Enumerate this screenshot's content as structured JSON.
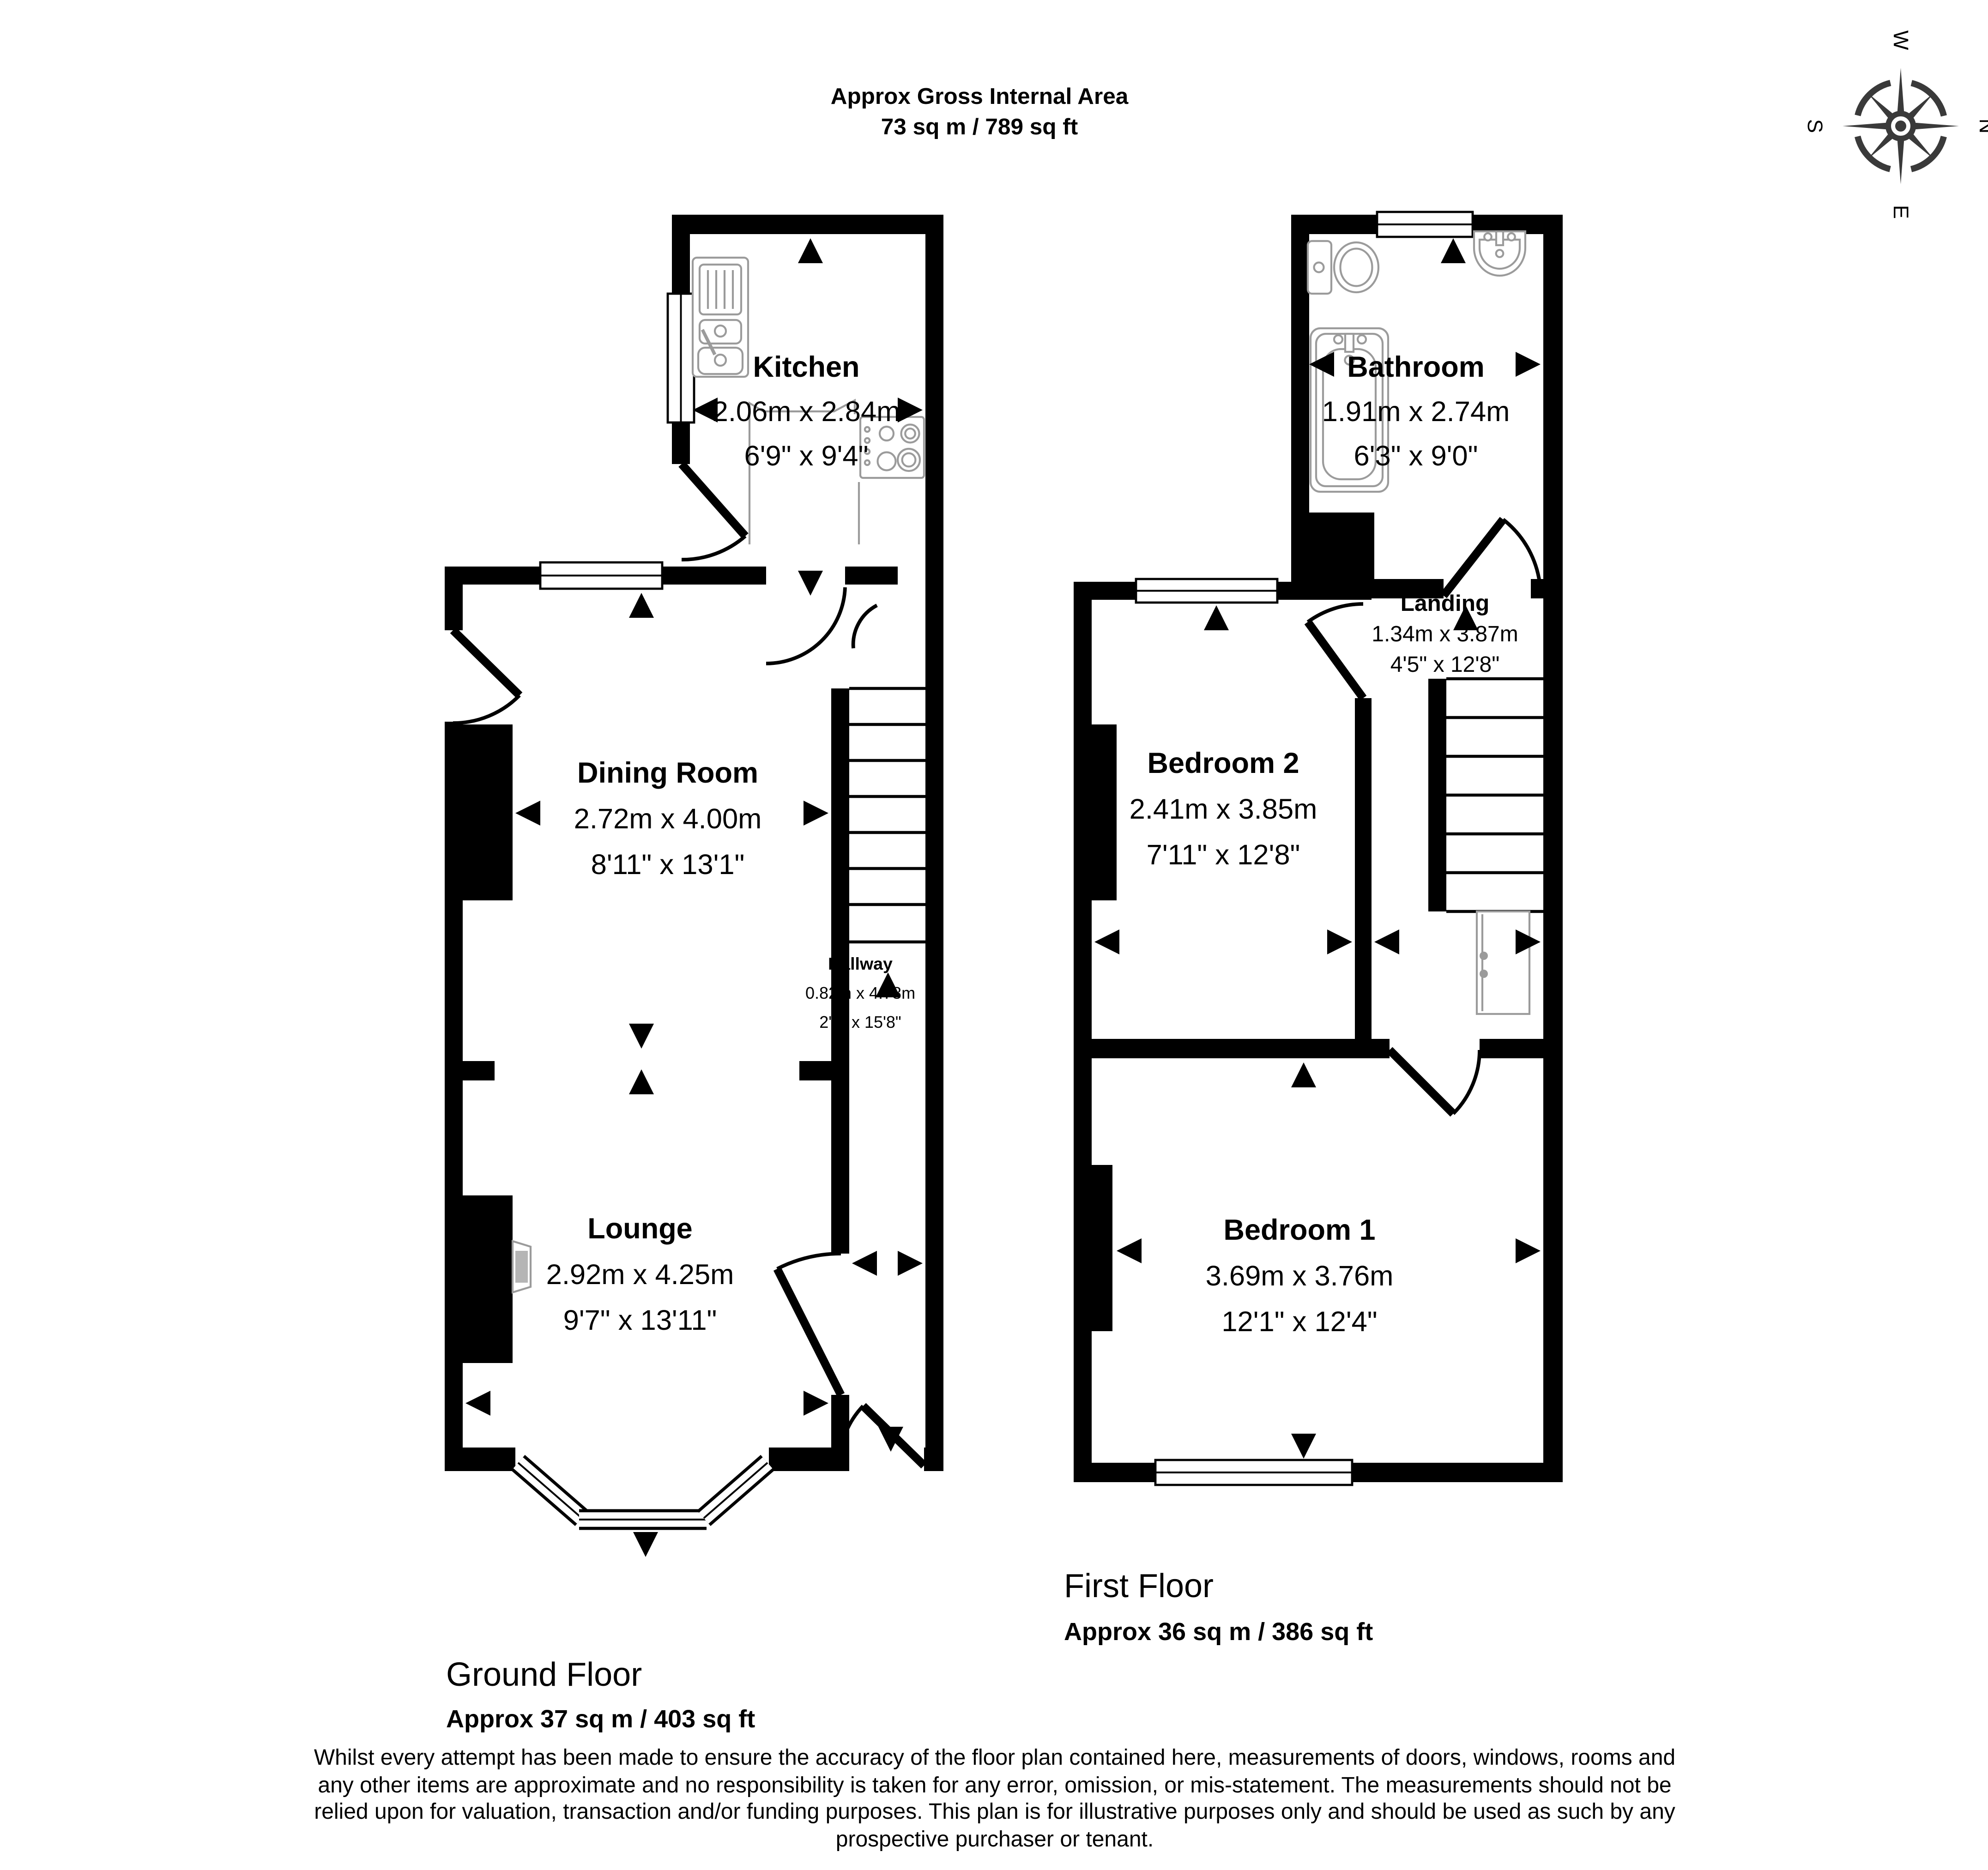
{
  "colors": {
    "wall": "#000000",
    "fixture": "#9b9b9b",
    "fireplace": "#b5b5b5",
    "compass": "#3a3a3a",
    "glass": "#ffffff"
  },
  "header": {
    "line1": "Approx Gross Internal Area",
    "line2": "73 sq m / 789 sq ft"
  },
  "compass": {
    "north": "N",
    "east": "E",
    "south": "S",
    "west": "W"
  },
  "floors": {
    "ground": {
      "title": "Ground Floor",
      "area": "Approx 37 sq m / 403 sq ft"
    },
    "first": {
      "title": "First Floor",
      "area": "Approx 36 sq m / 386 sq ft"
    }
  },
  "rooms": {
    "kitchen": {
      "name": "Kitchen",
      "dims_m": "2.06m x 2.84m",
      "dims_ft": "6'9\" x 9'4\""
    },
    "dining": {
      "name": "Dining Room",
      "dims_m": "2.72m x 4.00m",
      "dims_ft": "8'11\" x 13'1\""
    },
    "hallway": {
      "name": "Hallway",
      "dims_m": "0.82m x 4.78m",
      "dims_ft": "2'8\" x 15'8\""
    },
    "lounge": {
      "name": "Lounge",
      "dims_m": "2.92m x 4.25m",
      "dims_ft": "9'7\" x 13'11\""
    },
    "bathroom": {
      "name": "Bathroom",
      "dims_m": "1.91m x 2.74m",
      "dims_ft": "6'3\" x 9'0\""
    },
    "landing": {
      "name": "Landing",
      "dims_m": "1.34m x 3.87m",
      "dims_ft": "4'5\" x 12'8\""
    },
    "bedroom2": {
      "name": "Bedroom 2",
      "dims_m": "2.41m x 3.85m",
      "dims_ft": "7'11\" x 12'8\""
    },
    "bedroom1": {
      "name": "Bedroom 1",
      "dims_m": "3.69m x 3.76m",
      "dims_ft": "12'1\" x 12'4\""
    }
  },
  "disclaimer": {
    "lines": [
      "Whilst every attempt has been made to ensure the accuracy of the floor plan contained here, measurements of doors, windows, rooms and",
      "any other items are approximate and no responsibility is taken for any error, omission, or mis-statement. The measurements should not be",
      "relied upon for valuation, transaction and/or funding purposes. This plan is for illustrative purposes only and should be used as such by any",
      "prospective purchaser or tenant."
    ]
  }
}
